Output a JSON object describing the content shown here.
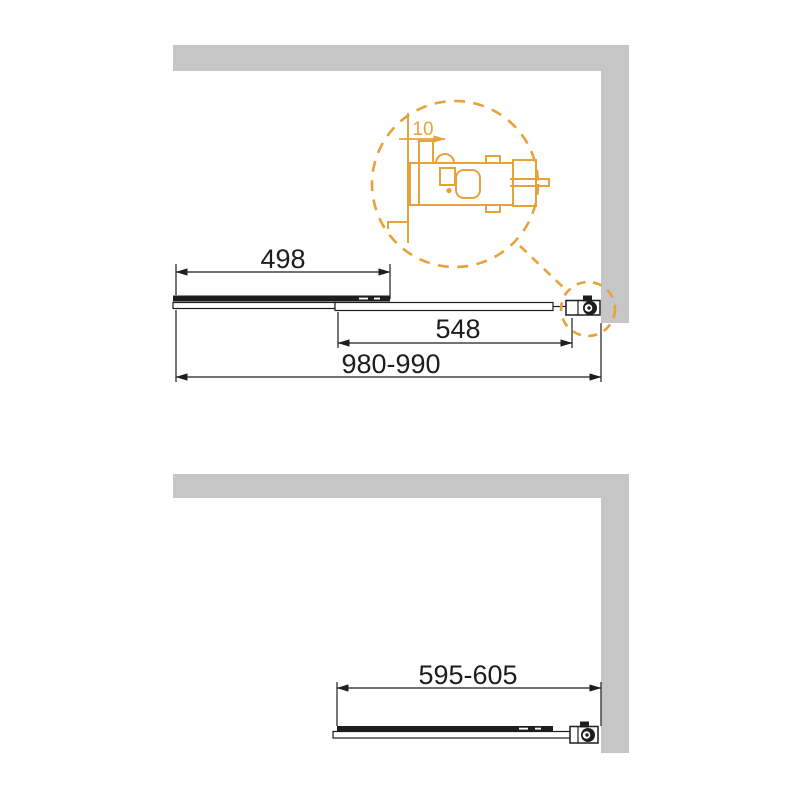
{
  "drawing": {
    "type": "technical-dimension-diagram",
    "subject": "sliding bath screen installation drawing, top view and plan view",
    "colors": {
      "wall": "#c6c6c6",
      "line": "#1d1d1d",
      "accent": "#e8a23c",
      "background": "#ffffff"
    },
    "top_view": {
      "dim_fixed_panel": "498",
      "dim_sliding_panel": "548",
      "dim_total_width": "980-990",
      "detail_bubble": {
        "dim_wall_clearance": "10"
      }
    },
    "plan_view": {
      "dim_total_width": "595-605"
    }
  }
}
